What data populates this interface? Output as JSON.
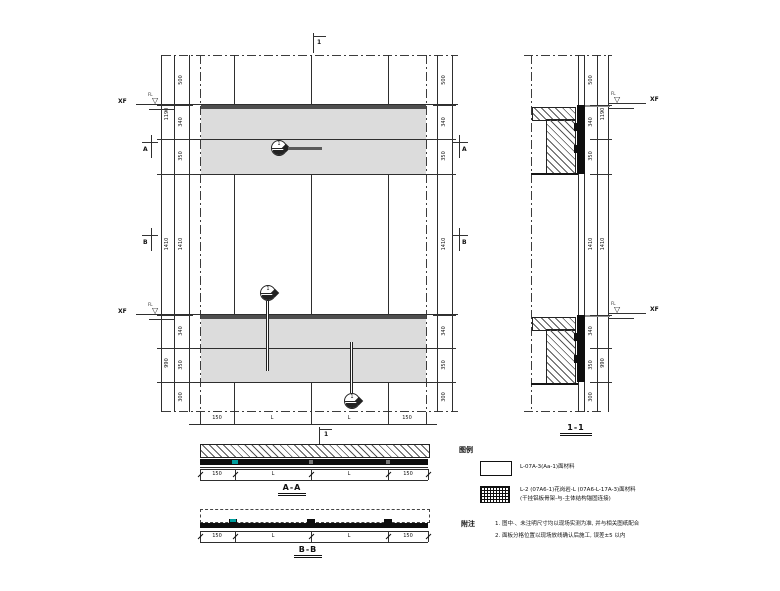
{
  "colors": {
    "paper": "#ffffff",
    "line": "#2e2e2e",
    "band_fill": "#dcdcdc",
    "panel_dark": "#0e0e0e",
    "level_strip": "#4e4e4e",
    "accent_teal": "#009e9e"
  },
  "markers": {
    "level_label": "XF",
    "level_flag": "FL",
    "cut_one": "1",
    "cut_a": "A",
    "cut_b": "B"
  },
  "callout_number": "1",
  "main_plan": {
    "dims_left_inner": [
      "500",
      "340",
      "350",
      "1410",
      "340",
      "350",
      "300"
    ],
    "dims_left_outer": [
      "1190",
      "1410",
      "990"
    ],
    "dims_right_inner": [
      "500",
      "340",
      "350",
      "1410",
      "340",
      "350",
      "300"
    ],
    "dims_bottom": [
      "150",
      "L",
      "L",
      "150"
    ]
  },
  "section_11": {
    "label": "1-1",
    "dims_inner": [
      "500",
      "340",
      "350",
      "1410",
      "340",
      "350",
      "300"
    ],
    "dims_outer": [
      "1190",
      "1410",
      "990"
    ]
  },
  "section_aa": {
    "label": "A-A",
    "dims": [
      "150",
      "L",
      "L",
      "150"
    ]
  },
  "section_bb": {
    "label": "B-B",
    "dims": [
      "150",
      "L",
      "L",
      "150"
    ]
  },
  "legend": {
    "title": "图例",
    "item1_text": "L-07A-3(Aa-1)面材料",
    "item2_line1": "L-2 (07A6-1)花岗岩-L (07A6-L-17A-3)面材料",
    "item2_line2": "(干挂铝板骨架-与-主体结构锚固连接)"
  },
  "notes": {
    "title": "附注",
    "line1": "1. 图中·、未注明尺寸均以现场实测为准, 并与相关图纸配合",
    "line2": "2. 面板分格位置以现场放线确认后施工, 误差±5 以内"
  }
}
